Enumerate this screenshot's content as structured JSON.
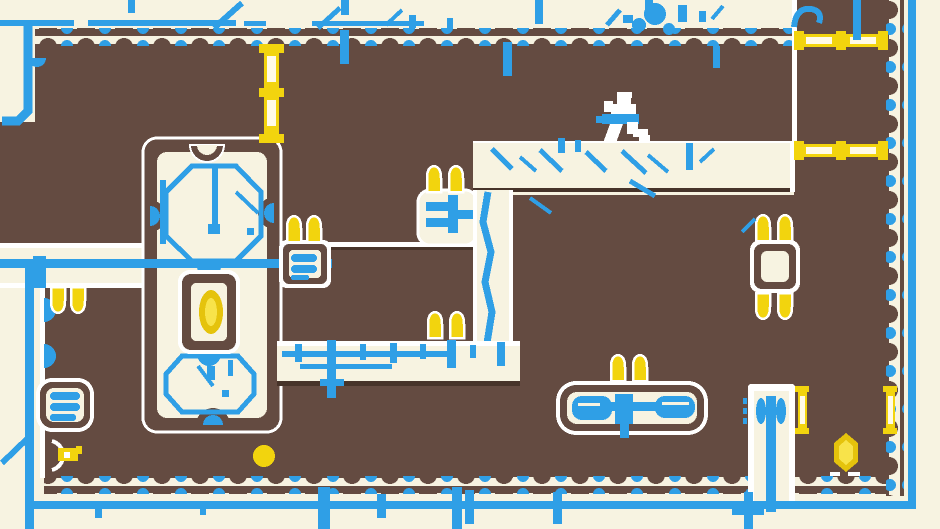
{
  "canvas": {
    "width": 940,
    "height": 529
  },
  "palette": {
    "cream": "#f7f3e1",
    "brown": "#644b41",
    "dark": "#47342a",
    "blue": "#2f9fe6",
    "white": "#ffffff",
    "yellow": "#f2d40e",
    "yellow_pale": "#fffbe8",
    "yellow_deep": "#e5c30c",
    "yellow_light": "#f8e34a"
  },
  "scene": {
    "type": "pixel-platformer-level",
    "player": {
      "name": "runner",
      "pose": "running",
      "body_color": "#ffffff",
      "scarf_color": "#2f9fe6"
    },
    "collectibles": {
      "crystal_gems": 2,
      "coins": 1,
      "keys": 1
    },
    "hazards": {
      "spike_pairs": 7,
      "spikes_total": 14,
      "spike_color": "#f2d40e"
    },
    "gates": {
      "large_segmented_gates": 3,
      "small_gate_bars": 2,
      "gate_color": "#f2d40e"
    },
    "devices": {
      "vent_fans": 3,
      "floating_spike_block": 1,
      "ice_crystal_blocks": 2,
      "rope_lines": 2
    }
  }
}
